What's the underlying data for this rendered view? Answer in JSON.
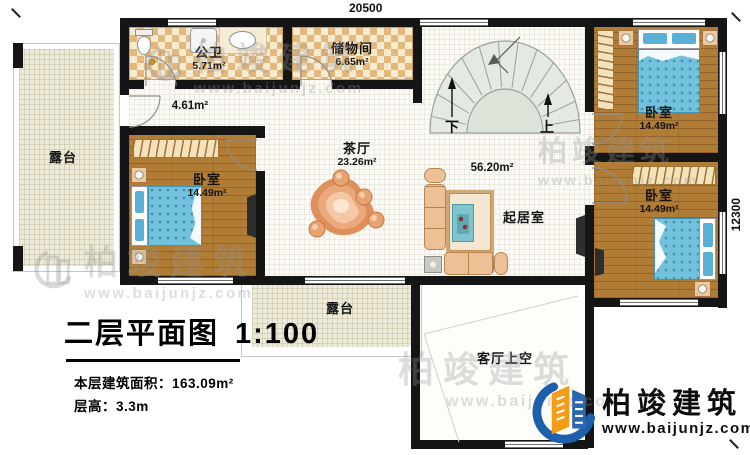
{
  "dimensions": {
    "top": "20500",
    "right": "12300"
  },
  "rooms": {
    "bathroom": {
      "name": "公卫",
      "area": "5.71m²"
    },
    "storage": {
      "name": "储物间",
      "area": "6.65m²"
    },
    "hallway": {
      "area": "4.61m²"
    },
    "tea_hall": {
      "name": "茶厅",
      "area": "23.26m²"
    },
    "open_area": {
      "area": "56.20m²"
    },
    "living_room": {
      "name": "起居室"
    },
    "bedroom_left": {
      "name": "卧室",
      "area": "14.49m²"
    },
    "bedroom_top_right": {
      "name": "卧室",
      "area": "14.49m²"
    },
    "bedroom_bottom_right": {
      "name": "卧室",
      "area": "14.49m²"
    },
    "terrace_left": {
      "name": "露台"
    },
    "terrace_bottom": {
      "name": "露台"
    },
    "void": {
      "name": "客厅上空"
    },
    "stairs": {
      "down_label": "下",
      "up_label": "上"
    }
  },
  "title_block": {
    "title": "二层平面图",
    "scale": "1:100",
    "floor_area_label": "本层建筑面积：163.09m²",
    "floor_height_label": "层高：3.3m"
  },
  "logo": {
    "company": "柏竣建筑",
    "website": "www.baijunjz.com"
  },
  "watermark": {
    "company": "柏竣建筑",
    "website": "www.baijunjz.com"
  },
  "colors": {
    "wall": "#151515",
    "wood_floor": "#b07c36",
    "tile_dark": "#e3b87c",
    "tile_light": "#f7ebcf",
    "terrace_floor": "#ecead9",
    "stair_fill": "#e2e8df",
    "bed_blue": "#72c2dd",
    "sofa_tan": "#eec096",
    "logo_blue": "#1d5fab",
    "logo_orange": "#f49c15"
  }
}
